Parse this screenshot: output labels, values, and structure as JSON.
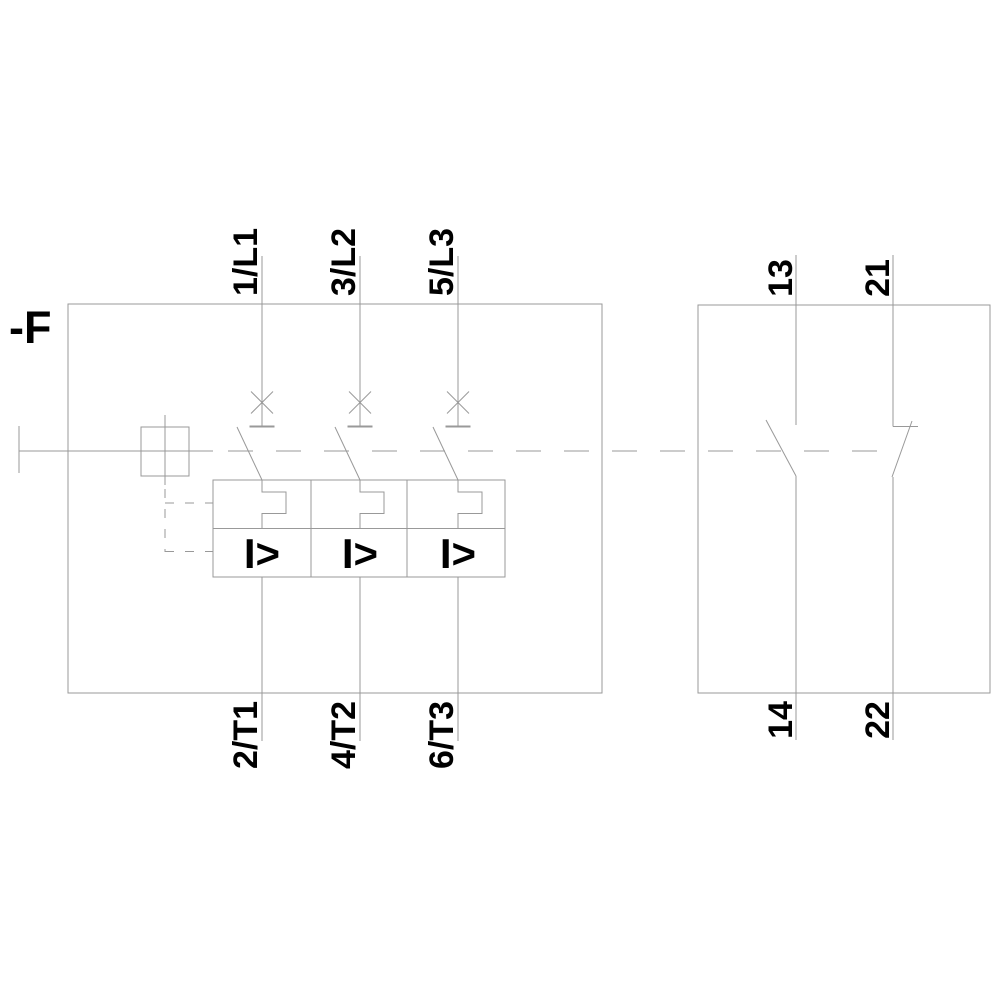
{
  "schematic": {
    "designator": "-F",
    "main_poles": {
      "top_terminals": [
        "1/L1",
        "3/L2",
        "5/L3"
      ],
      "bottom_terminals": [
        "2/T1",
        "4/T2",
        "6/T3"
      ],
      "overcurrent_symbol": "I>"
    },
    "aux_contacts": {
      "no_top": "13",
      "no_bottom": "14",
      "nc_top": "21",
      "nc_bottom": "22"
    },
    "colors": {
      "line": "#999999",
      "text": "#000000",
      "background": "#ffffff"
    }
  }
}
